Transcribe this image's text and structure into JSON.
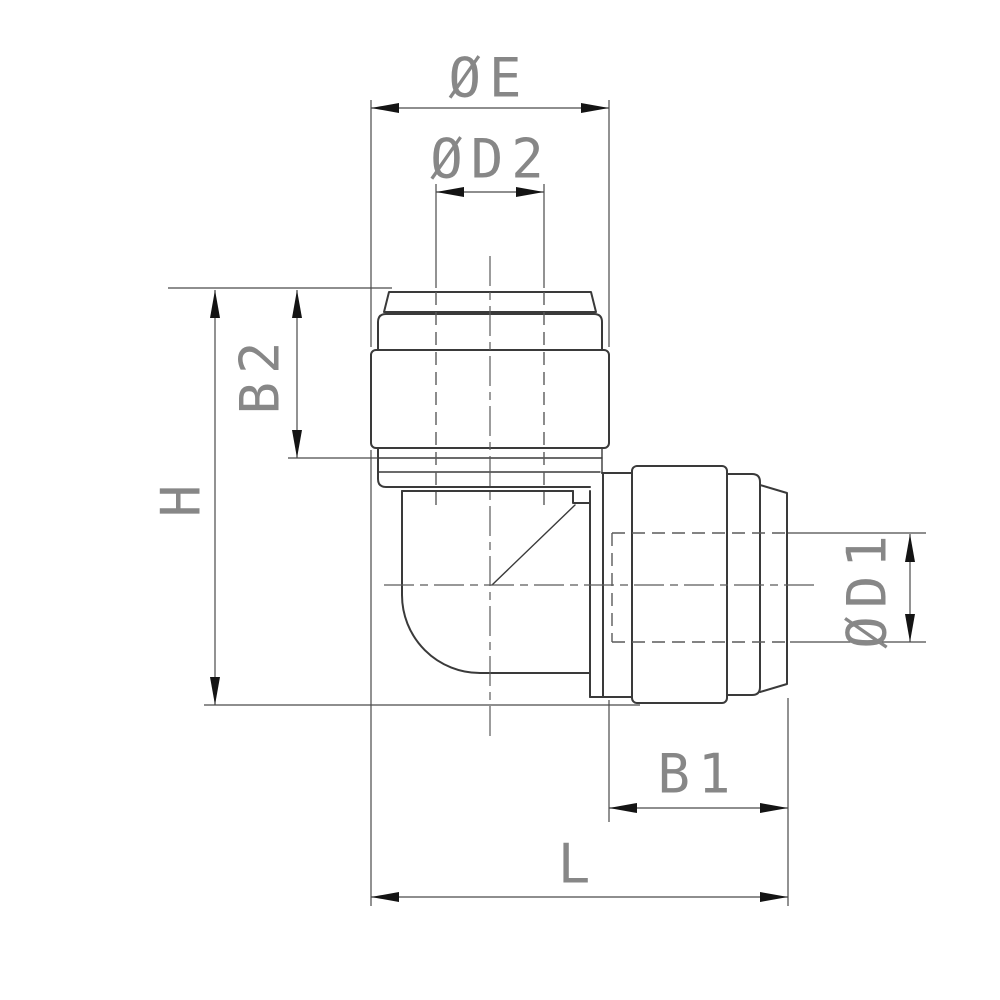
{
  "colors": {
    "background": "#ffffff",
    "line": "#3a3a3a",
    "thin_line": "#5a5a5a",
    "dim_line": "#4a4a4a",
    "text": "#878787",
    "arrow": "#141414"
  },
  "labels": {
    "dia_e": "ØE",
    "dia_d2": "ØD2",
    "b2": "B2",
    "h": "H",
    "dia_d1": "ØD1",
    "b1": "B1",
    "l": "L"
  }
}
